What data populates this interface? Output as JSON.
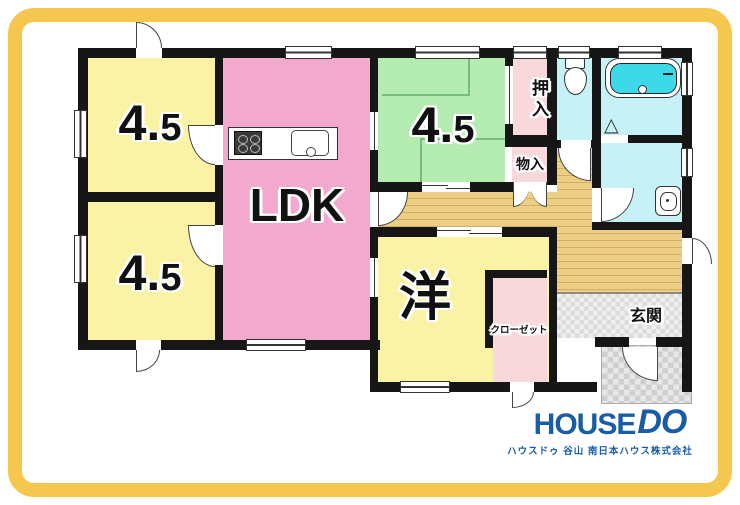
{
  "floorplan": {
    "rooms": {
      "tatami_a": {
        "label": "4.5",
        "color": "#FAF3A5"
      },
      "tatami_b": {
        "label": "4.5",
        "color": "#FAF3A5"
      },
      "ldk": {
        "label": "LDK",
        "color": "#F3A9CD"
      },
      "tatami_c": {
        "label": "4.5",
        "color": "#B4ECB2"
      },
      "oshiire": {
        "label": "押入",
        "color": "#F8D8DB"
      },
      "monoire": {
        "label": "物入",
        "color": "#F8D8DB"
      },
      "western": {
        "label": "洋",
        "color": "#FAF3A5"
      },
      "closet": {
        "label": "クローゼット",
        "color": "#F8D8DB"
      },
      "genkan": {
        "label": "玄関",
        "color": "#E8E8E8"
      },
      "toilet": {
        "color": "#C6F2F7"
      },
      "bathroom": {
        "color": "#C6F2F7"
      },
      "washroom": {
        "color": "#C6F2F7"
      },
      "corridor": {
        "color": "#EACC80"
      }
    },
    "icons": {
      "folding_door": "△"
    },
    "style": {
      "wall_color": "#161616",
      "frame_color": "#F5C74E",
      "bath_water_color": "#3ED9E8"
    }
  },
  "branding": {
    "logo_house": "HOUSE",
    "logo_do": "DO",
    "logo_color": "#1B5CA7",
    "tagline": "ハウスドゥ 谷山  南日本ハウス株式会社"
  }
}
